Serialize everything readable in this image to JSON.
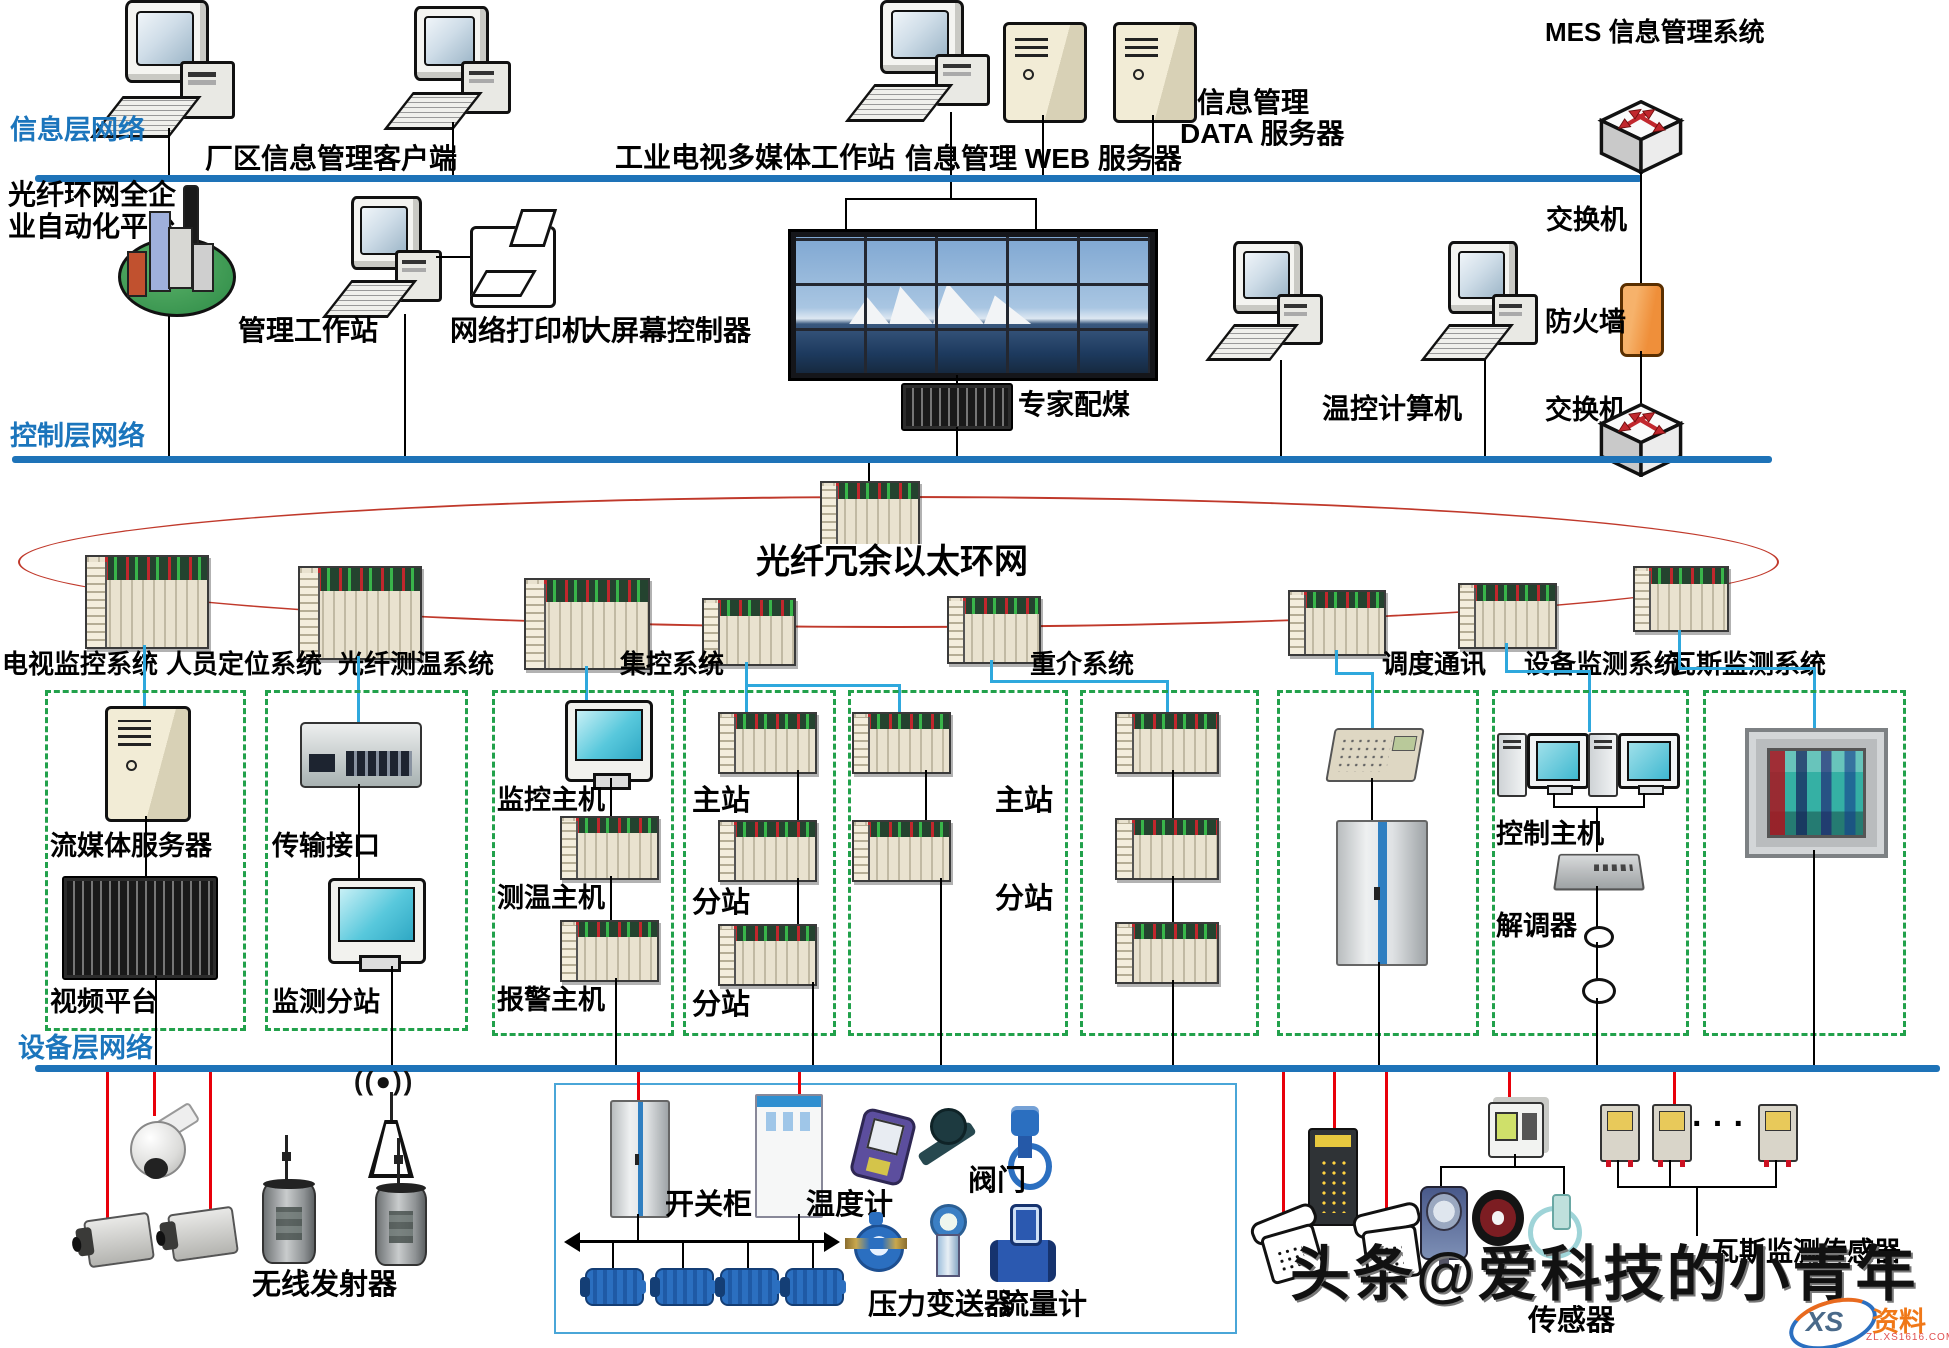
{
  "header": {
    "mes_title": "MES 信息管理系统"
  },
  "layers": {
    "info": "信息层网络",
    "control": "控制层网络",
    "device": "设备层网络"
  },
  "info_layer": {
    "client": "厂区信息管理客户端",
    "tv_workstation": "工业电视多媒体工作站",
    "web_server": "信息管理 WEB 服务器",
    "data_server_line1": "信息管理",
    "data_server_line2": "DATA 服务器",
    "switch_label": "交换机"
  },
  "control_layer": {
    "platform_line1": "光纤环网全企",
    "platform_line2": "业自动化平台",
    "mgmt_workstation": "管理工作站",
    "printer": "网络打印机",
    "screen_controller": "大屏幕控制器",
    "expert_coal": "专家配煤",
    "temp_computer": "温控计算机",
    "firewall": "防火墙",
    "switch_label": "交换机"
  },
  "ring": {
    "title": "光纤冗余以太环网",
    "labels": [
      "电视监控系统",
      "人员定位系统",
      "光纤测温系统",
      "集控系统",
      "重介系统",
      "调度通讯",
      "设备监测系统",
      "瓦斯监测系统"
    ]
  },
  "boxes": {
    "tv": {
      "streaming_server": "流媒体服务器",
      "video_platform": "视频平台"
    },
    "personnel": {
      "transmission_iface": "传输接口",
      "monitor_substation": "监测分站"
    },
    "fiber_temp": {
      "monitor_host": "监控主机",
      "temp_host": "测温主机",
      "alarm_host": "报警主机"
    },
    "central_a": {
      "master": "主站",
      "slave1": "分站",
      "slave2": "分站"
    },
    "central_b": {
      "master": "主站",
      "slave": "分站"
    },
    "device_monitor": {
      "control_host": "控制主机",
      "demodulator": "解调器"
    }
  },
  "bottom": {
    "wireless_tx": "无线发射器",
    "switch_cabinet": "开关柜",
    "thermometer": "温度计",
    "valve": "阀门",
    "pressure_transmitter": "压力变送器",
    "flow_meter": "流量计",
    "sensor": "传感器",
    "gas_sensors": "瓦斯监测传感器",
    "dots": "· · ·",
    "antenna_waves": "((●))"
  },
  "watermark": {
    "text": "头条@爱科技的小青年",
    "logo_xs": "XS",
    "logo_name": "资料网",
    "logo_domain": "ZL.XS1616.COM"
  },
  "colors": {
    "bus": "#1e73b8",
    "layer_label": "#1b75bc",
    "ring": "#c0392b",
    "dashed_box": "#22a14b",
    "blue_link": "#2fa8dd",
    "red_link": "#e8000a",
    "firewall": "#ef8f3a"
  }
}
